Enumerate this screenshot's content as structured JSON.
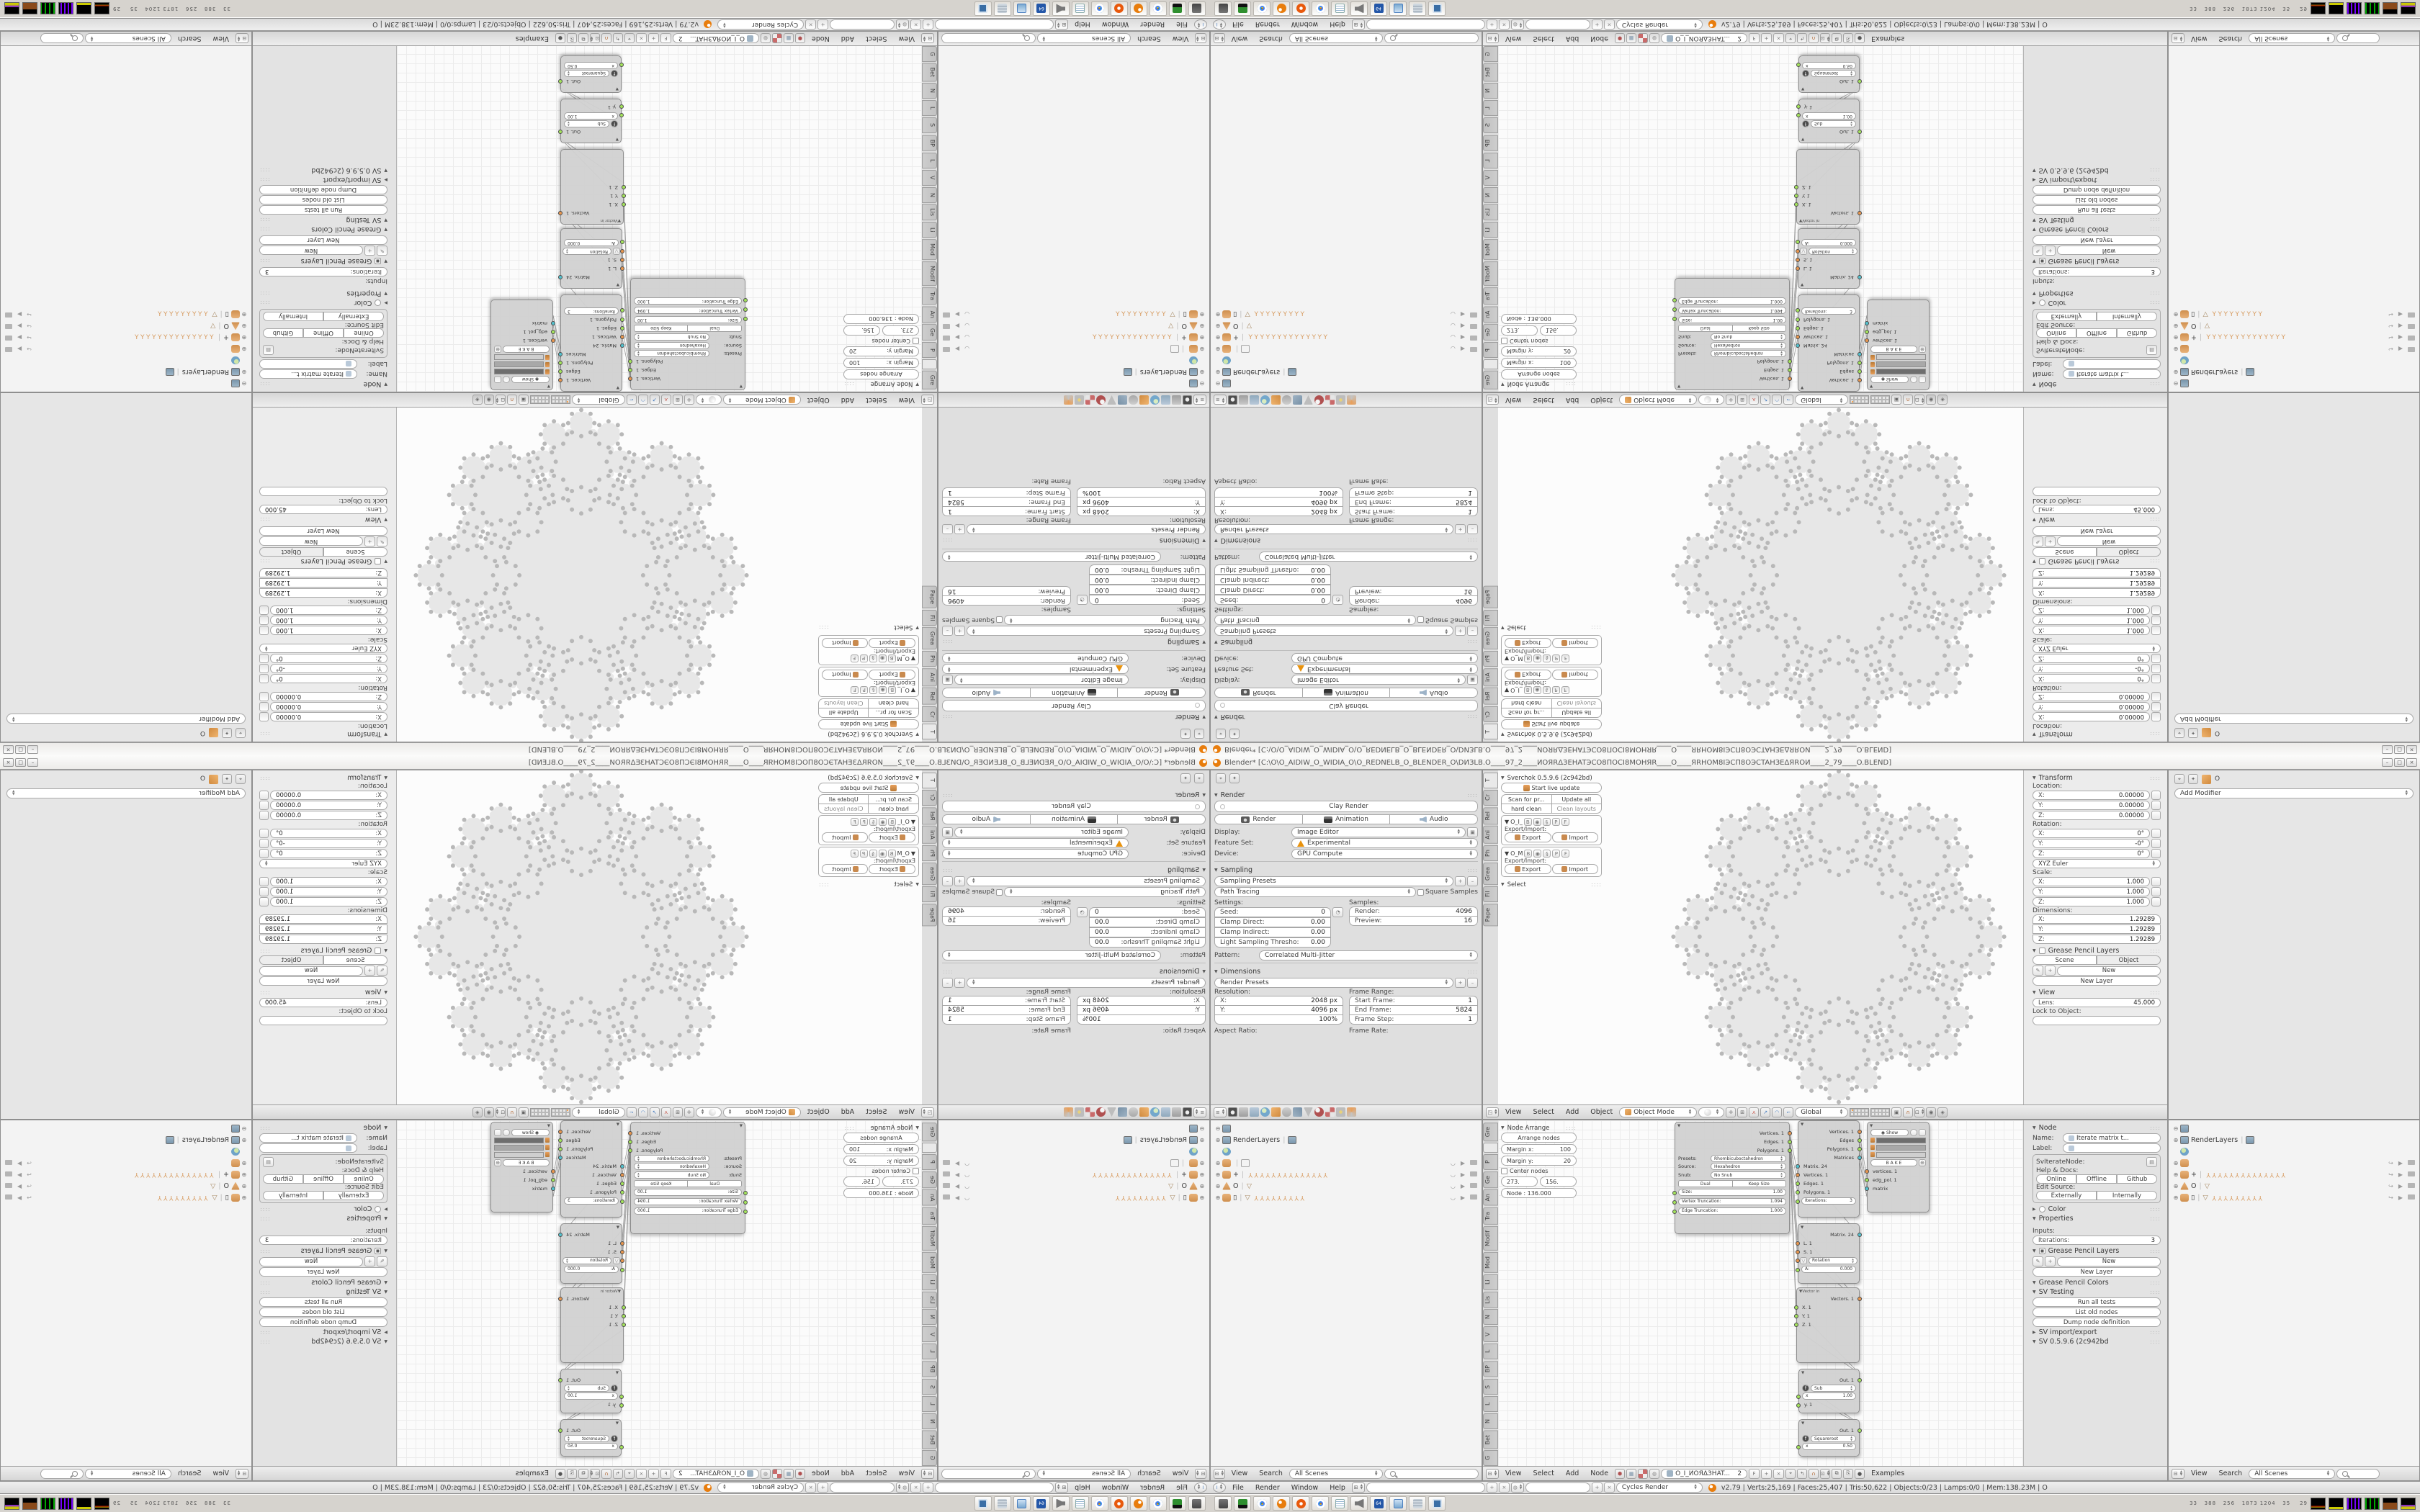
{
  "window": {
    "title": "Blender* [C:\\O\\O_AIDIW_O_WIDIA_O\\O_REDNELB_O_BLENDER_O\\DИЗLB.O____97_2____ИOЯRΔЗEHATЭCO8ПOCI8MOHЯR____O____ЯRHOM8IЭCП8OЭCTAHЗEΔЯROИ____2_79____O.BLEND]",
    "min": "–",
    "max": "□",
    "close": "×"
  },
  "props_render": {
    "panel_render": "Render",
    "clay": "Clay Render",
    "btn_render": "Render",
    "btn_animation": "Animation",
    "btn_audio": "Audio",
    "display_label": "Display:",
    "display": "Image Editor",
    "feature_label": "Feature Set:",
    "feature": "Experimental",
    "device_label": "Device:",
    "device": "GPU Compute",
    "panel_sampling": "Sampling",
    "sampling_presets": "Sampling Presets",
    "integrator": "Path Tracing",
    "square_samples": "Square Samples",
    "settings_label": "Settings:",
    "samples_label": "Samples:",
    "seed_label": "Seed:",
    "seed": "0",
    "clamp_direct_label": "Clamp Direct:",
    "clamp_direct": "0.00",
    "clamp_indirect_label": "Clamp Indirect:",
    "clamp_indirect": "0.00",
    "light_thresh_label": "Light Sampling Thresho:",
    "light_thresh": "0.00",
    "render_s_label": "Render:",
    "render_s": "4096",
    "preview_s_label": "Preview:",
    "preview_s": "16",
    "pattern_label": "Pattern:",
    "pattern": "Correlated Multi-Jitter",
    "panel_dimensions": "Dimensions",
    "render_presets": "Render Presets",
    "resolution_label": "Resolution:",
    "x_label": "X:",
    "res_x": "2048 px",
    "y_label": "Y:",
    "res_y": "4096 px",
    "res_pct": "100%",
    "frame_range_label": "Frame Range:",
    "start_label": "Start Frame:",
    "start": "1",
    "end_label": "End Frame:",
    "end": "5824",
    "step_label": "Frame Step:",
    "step": "1",
    "aspect_label": "Aspect Ratio:",
    "frame_rate_label": "Frame Rate:"
  },
  "view3d": {
    "tabs": [
      "T",
      "Cr",
      "Rel",
      "Ani",
      "Ph",
      "Grea",
      "Fil",
      "Pape"
    ],
    "sverchok": {
      "title": "Sverchok 0.5.9.6 (2c942bd)",
      "start": "Start live update",
      "scan": "Scan for pr...",
      "update": "Update all",
      "hard": "hard clean",
      "clean": "Clean layouts",
      "g1": "O_I_",
      "g2": "O_M",
      "b": "B",
      "p": "P",
      "f": "F",
      "exim": "Export/Import:",
      "export": "Export",
      "import": "Import",
      "select": "Select"
    },
    "header": {
      "m0": "View",
      "m1": "Select",
      "m2": "Add",
      "m3": "Object",
      "mode": "Object Mode",
      "orientation": "Global"
    },
    "np": {
      "transform": "Transform",
      "location": "Location:",
      "x": "X:",
      "y": "Y:",
      "z": "Z:",
      "loc0": "0.00000",
      "loc1": "0.00000",
      "loc2": "0.00000",
      "rotation": "Rotation:",
      "rot0": "0°",
      "rot1": "-0°",
      "rot2": "0°",
      "euler": "XYZ Euler",
      "scale": "Scale:",
      "scl": "1.000",
      "dimensions": "Dimensions:",
      "dim": "1.29289",
      "gp": "Grease Pencil Layers",
      "scene": "Scene",
      "object": "Object",
      "new": "New",
      "new_layer": "New Layer",
      "view": "View",
      "lens_label": "Lens:",
      "lens": "45.000",
      "lock": "Lock to Object:"
    }
  },
  "props_modifier": {
    "object": "O",
    "add": "Add Modifier"
  },
  "outliner": {
    "renderlayers": "RenderLayers",
    "plus": "+",
    "o": "O",
    "box": "▯",
    "tripods14": "YYYYYYYYYYYYYY",
    "tripods9": "YYYYYYYYY",
    "view": "View",
    "search": "Search",
    "scenes": "All Scenes"
  },
  "nodeed": {
    "tabs": [
      "Gre",
      "",
      "P",
      "Ge",
      "An",
      "Tra",
      "Modif",
      "Mod",
      "Li",
      "Lis",
      "N",
      "V",
      "L",
      "BP",
      "S",
      "L",
      "N",
      "Bet",
      "G"
    ],
    "arrange": {
      "title": "Node Arrange",
      "btn": "Arrange nodes",
      "mx": "Margin x:",
      "mxv": "100",
      "my": "Margin y:",
      "myv": "20",
      "center": "Center nodes",
      "n1": "273.",
      "n2": "156.",
      "node": "Node : 136.000"
    },
    "header": {
      "m0": "View",
      "m1": "Select",
      "m2": "Add",
      "m3": "Node",
      "tree": "O_I_ИOЯΔЗHAT...",
      "idx": "2",
      "f": "F",
      "examples": "Examples"
    },
    "np": {
      "node": "Node",
      "name_label": "Name:",
      "name": "Iterate matrix t...",
      "label_label": "Label:",
      "cls": "SvIterateNode:",
      "help": "Help & Docs:",
      "online": "Online",
      "offline": "Offline",
      "github": "Github",
      "edit": "Edit Source:",
      "ext": "Externally",
      "int": "Internally",
      "color": "Color",
      "props": "Properties",
      "inputs": "Inputs:",
      "iter_label": "Iterations:",
      "iter": "3",
      "gp": "Grease Pencil Layers",
      "new": "New",
      "new_layer": "New Layer",
      "gpc": "Grease Pencil Colors",
      "svt": "SV Testing",
      "run": "Run all tests",
      "list": "List old nodes",
      "dump": "Dump node definition",
      "svio": "SV import/export",
      "ver": "SV 0.5.9.6 (2c942bd"
    },
    "gen": {
      "o0": "Vertices. 1",
      "o1": "Edges. 1",
      "o2": "Polygons. 1",
      "presets_label": "Presets:",
      "presets": "Rhombicuboctahedron",
      "source_label": "Source:",
      "source": "Hexahedron",
      "snub_label": "Snub:",
      "snub": "No Snub",
      "dual": "Dual",
      "keep": "Keep Size",
      "size_label": "Size:",
      "size": "1.00",
      "vt_label": "Vertex Truncation:",
      "vt": "1.094",
      "et_label": "Edge Truncation:",
      "et": "1.000"
    },
    "iter": {
      "o0": "Vertices. 1",
      "o1": "Edges",
      "o2": "Polygons. 1",
      "o3": "Matrices",
      "i0": "Matrix. 24",
      "i1": "Vertices. 1",
      "i2": "Edges. 1",
      "i3": "Polygons. 1",
      "iter_label": "Iterations:",
      "iter": "3"
    },
    "viewer": {
      "show": "Show",
      "bake": "B A K E",
      "i0": "vertices. 1",
      "i1": "edg_pol. 1",
      "i2": "matrix"
    },
    "matrix": {
      "out": "Matrix. 24",
      "l": "L. 1",
      "s": "S. 1",
      "rot": "Rotation",
      "a_label": "A:",
      "a": "0.000"
    },
    "vector": {
      "title": "Vector in",
      "out": "Vectors. 1",
      "x": "X. 1",
      "y": "Y. 1",
      "z": "Z. 1"
    },
    "math1": {
      "out": "Out. 1",
      "fn": "Sub",
      "x_label": "x",
      "x": "1.00",
      "y": "y. 1"
    },
    "math2": {
      "out": "Out. 1",
      "fn": "Squareroot",
      "x_label": "x",
      "x": "0.50"
    }
  },
  "infobar": {
    "m0": "File",
    "m1": "Render",
    "m2": "Window",
    "m3": "Help",
    "engine": "Cycles Render",
    "stats": "v2.79 | Verts:25,169 | Faces:25,407 | Tris:50,622 | Objects:0/23 | Lamps:0/0 | Mem:138.23M | O"
  },
  "taskbar": {
    "tray": "33   388   256   1873 1204   35    29"
  },
  "colors": {
    "socket_vertex": "#e7964f",
    "socket_data": "#a4e45c",
    "socket_matrix": "#53c2cf",
    "blender_orange": "#e87d0d",
    "active_layer": "#ff8c19"
  }
}
